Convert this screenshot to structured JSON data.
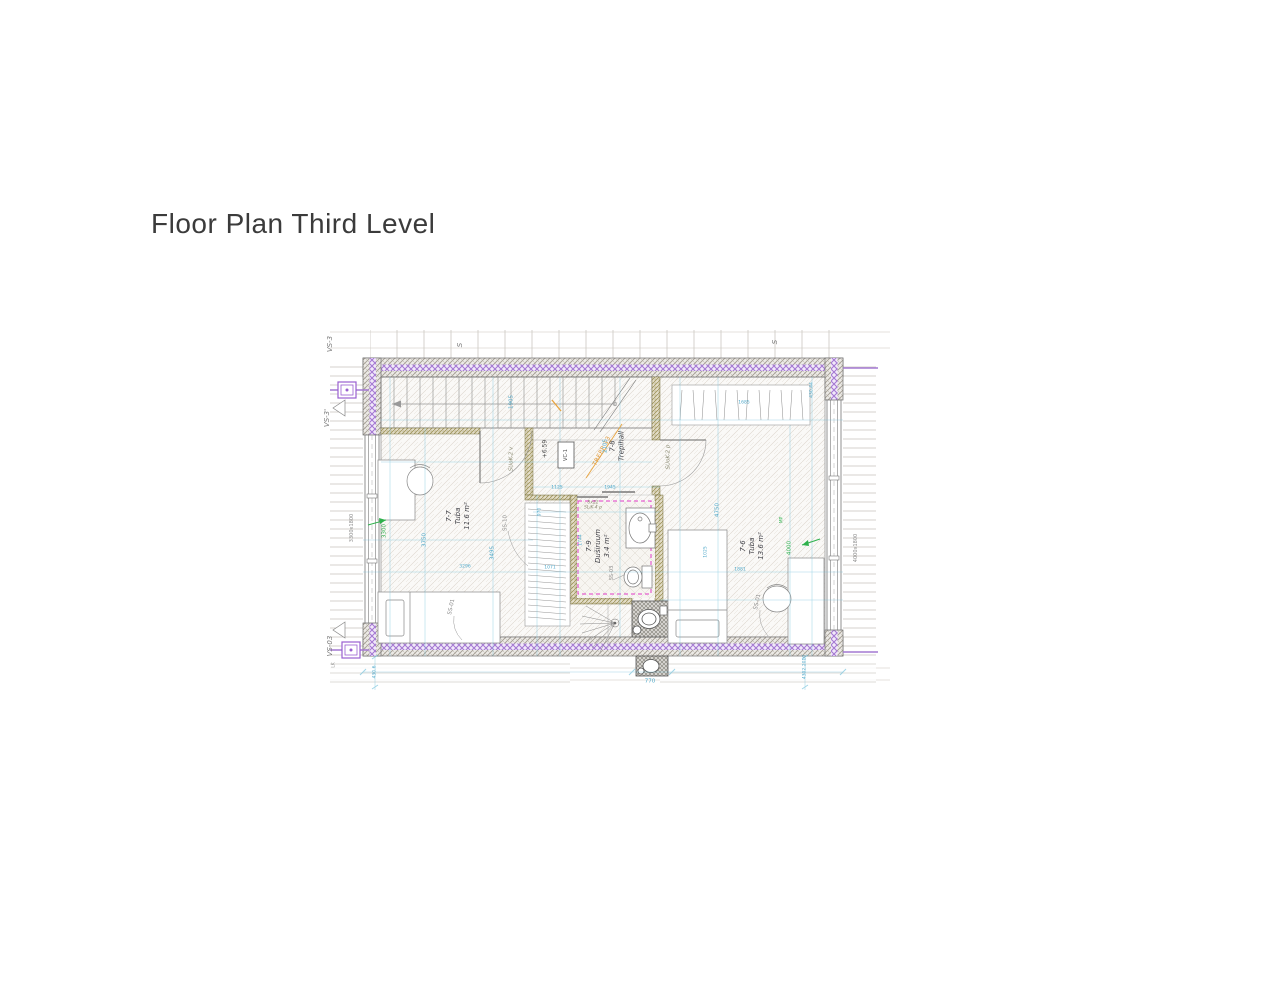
{
  "page": {
    "title": "Floor Plan Third Level"
  },
  "plan": {
    "markers": {
      "vs3": "VS-3",
      "vs3_prime": "VS-3'",
      "vs03": "VS-03",
      "s_left": "S",
      "s_right": "S",
      "lk": "LK"
    },
    "rooms": {
      "r77": {
        "num": "7-7",
        "name": "Tuba",
        "area": "11.6 m²"
      },
      "r78": {
        "num": "7-8",
        "name": "Trepihall"
      },
      "r79": {
        "num": "7-9",
        "name": "Duširuum",
        "area": "3.4 m²"
      },
      "r76": {
        "num": "7-6",
        "name": "Tuba",
        "area": "13.6 m²"
      }
    },
    "annotations": {
      "level": "+6.59",
      "vent_box": "VC-1",
      "stair_note": "TREPP 13",
      "door_left": "SUoK-2 v",
      "door_right": "SUoK-2 p",
      "door_shower": "SLiK-4 p",
      "door_shower_size": "8x22"
    },
    "furniture": {
      "bed_left": "SS-01",
      "bed_right": "SS-01",
      "wardrobe": "SS-10",
      "wc": "SS-03"
    },
    "windows": {
      "left": "3300x1800",
      "right": "4000x1800"
    },
    "dims": {
      "stairs_depth": "1905",
      "hall_height": "2105",
      "hall_w1": "1125",
      "hall_w2": "1945",
      "window_left_span": "3300",
      "window_right_span": "4000",
      "mp": "MP",
      "room77_d1": "3750",
      "room77_d2": "3495",
      "room77_width": "3296",
      "room76_height": "4750",
      "closet_width": "1685",
      "corner_top_right": "430.44",
      "room76_d1": "1881",
      "room76_d2": "1025",
      "shaft_width": "770",
      "corner_bottom_left": "430.6",
      "corner_bottom_right": "4302.2010",
      "shower_left": "1744",
      "wardrobe_d1": "970",
      "wardrobe_d2": "1071"
    },
    "colors": {
      "dimension_cyan": "#4fa8c9",
      "annotation_green": "#2eb14c",
      "stair_orange": "#e09a3c",
      "wall_purple": "#a478d2",
      "shower_magenta": "#e23cc8"
    }
  }
}
